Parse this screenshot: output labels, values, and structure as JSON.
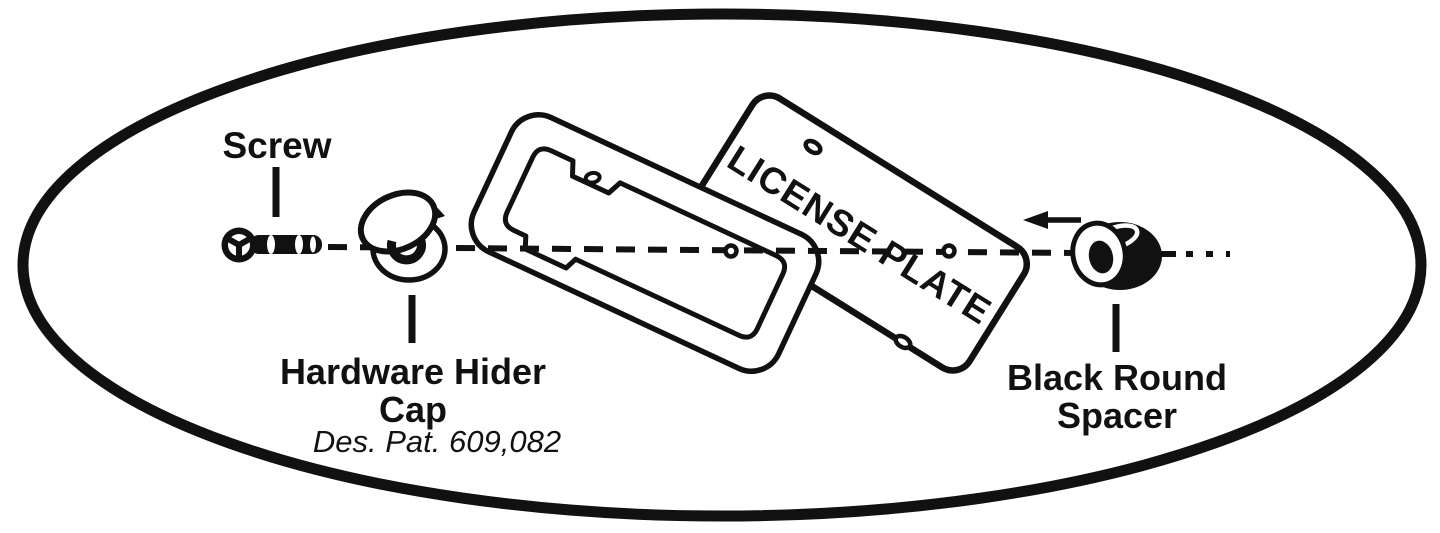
{
  "background": "#ffffff",
  "ink": "#111111",
  "diagram": {
    "type": "exploded-assembly-instructions",
    "subject": "license-plate-frame-hardware",
    "parts": [
      {
        "id": "screw",
        "label": "Screw"
      },
      {
        "id": "hardware-hider-cap",
        "label_line1": "Hardware Hider",
        "label_line2": "Cap",
        "patent": "Des. Pat. 609,082"
      },
      {
        "id": "license-plate-frame"
      },
      {
        "id": "license-plate",
        "label": "LICENSE PLATE"
      },
      {
        "id": "black-round-spacer",
        "label_line1": "Black Round",
        "label_line2": "Spacer"
      }
    ]
  }
}
